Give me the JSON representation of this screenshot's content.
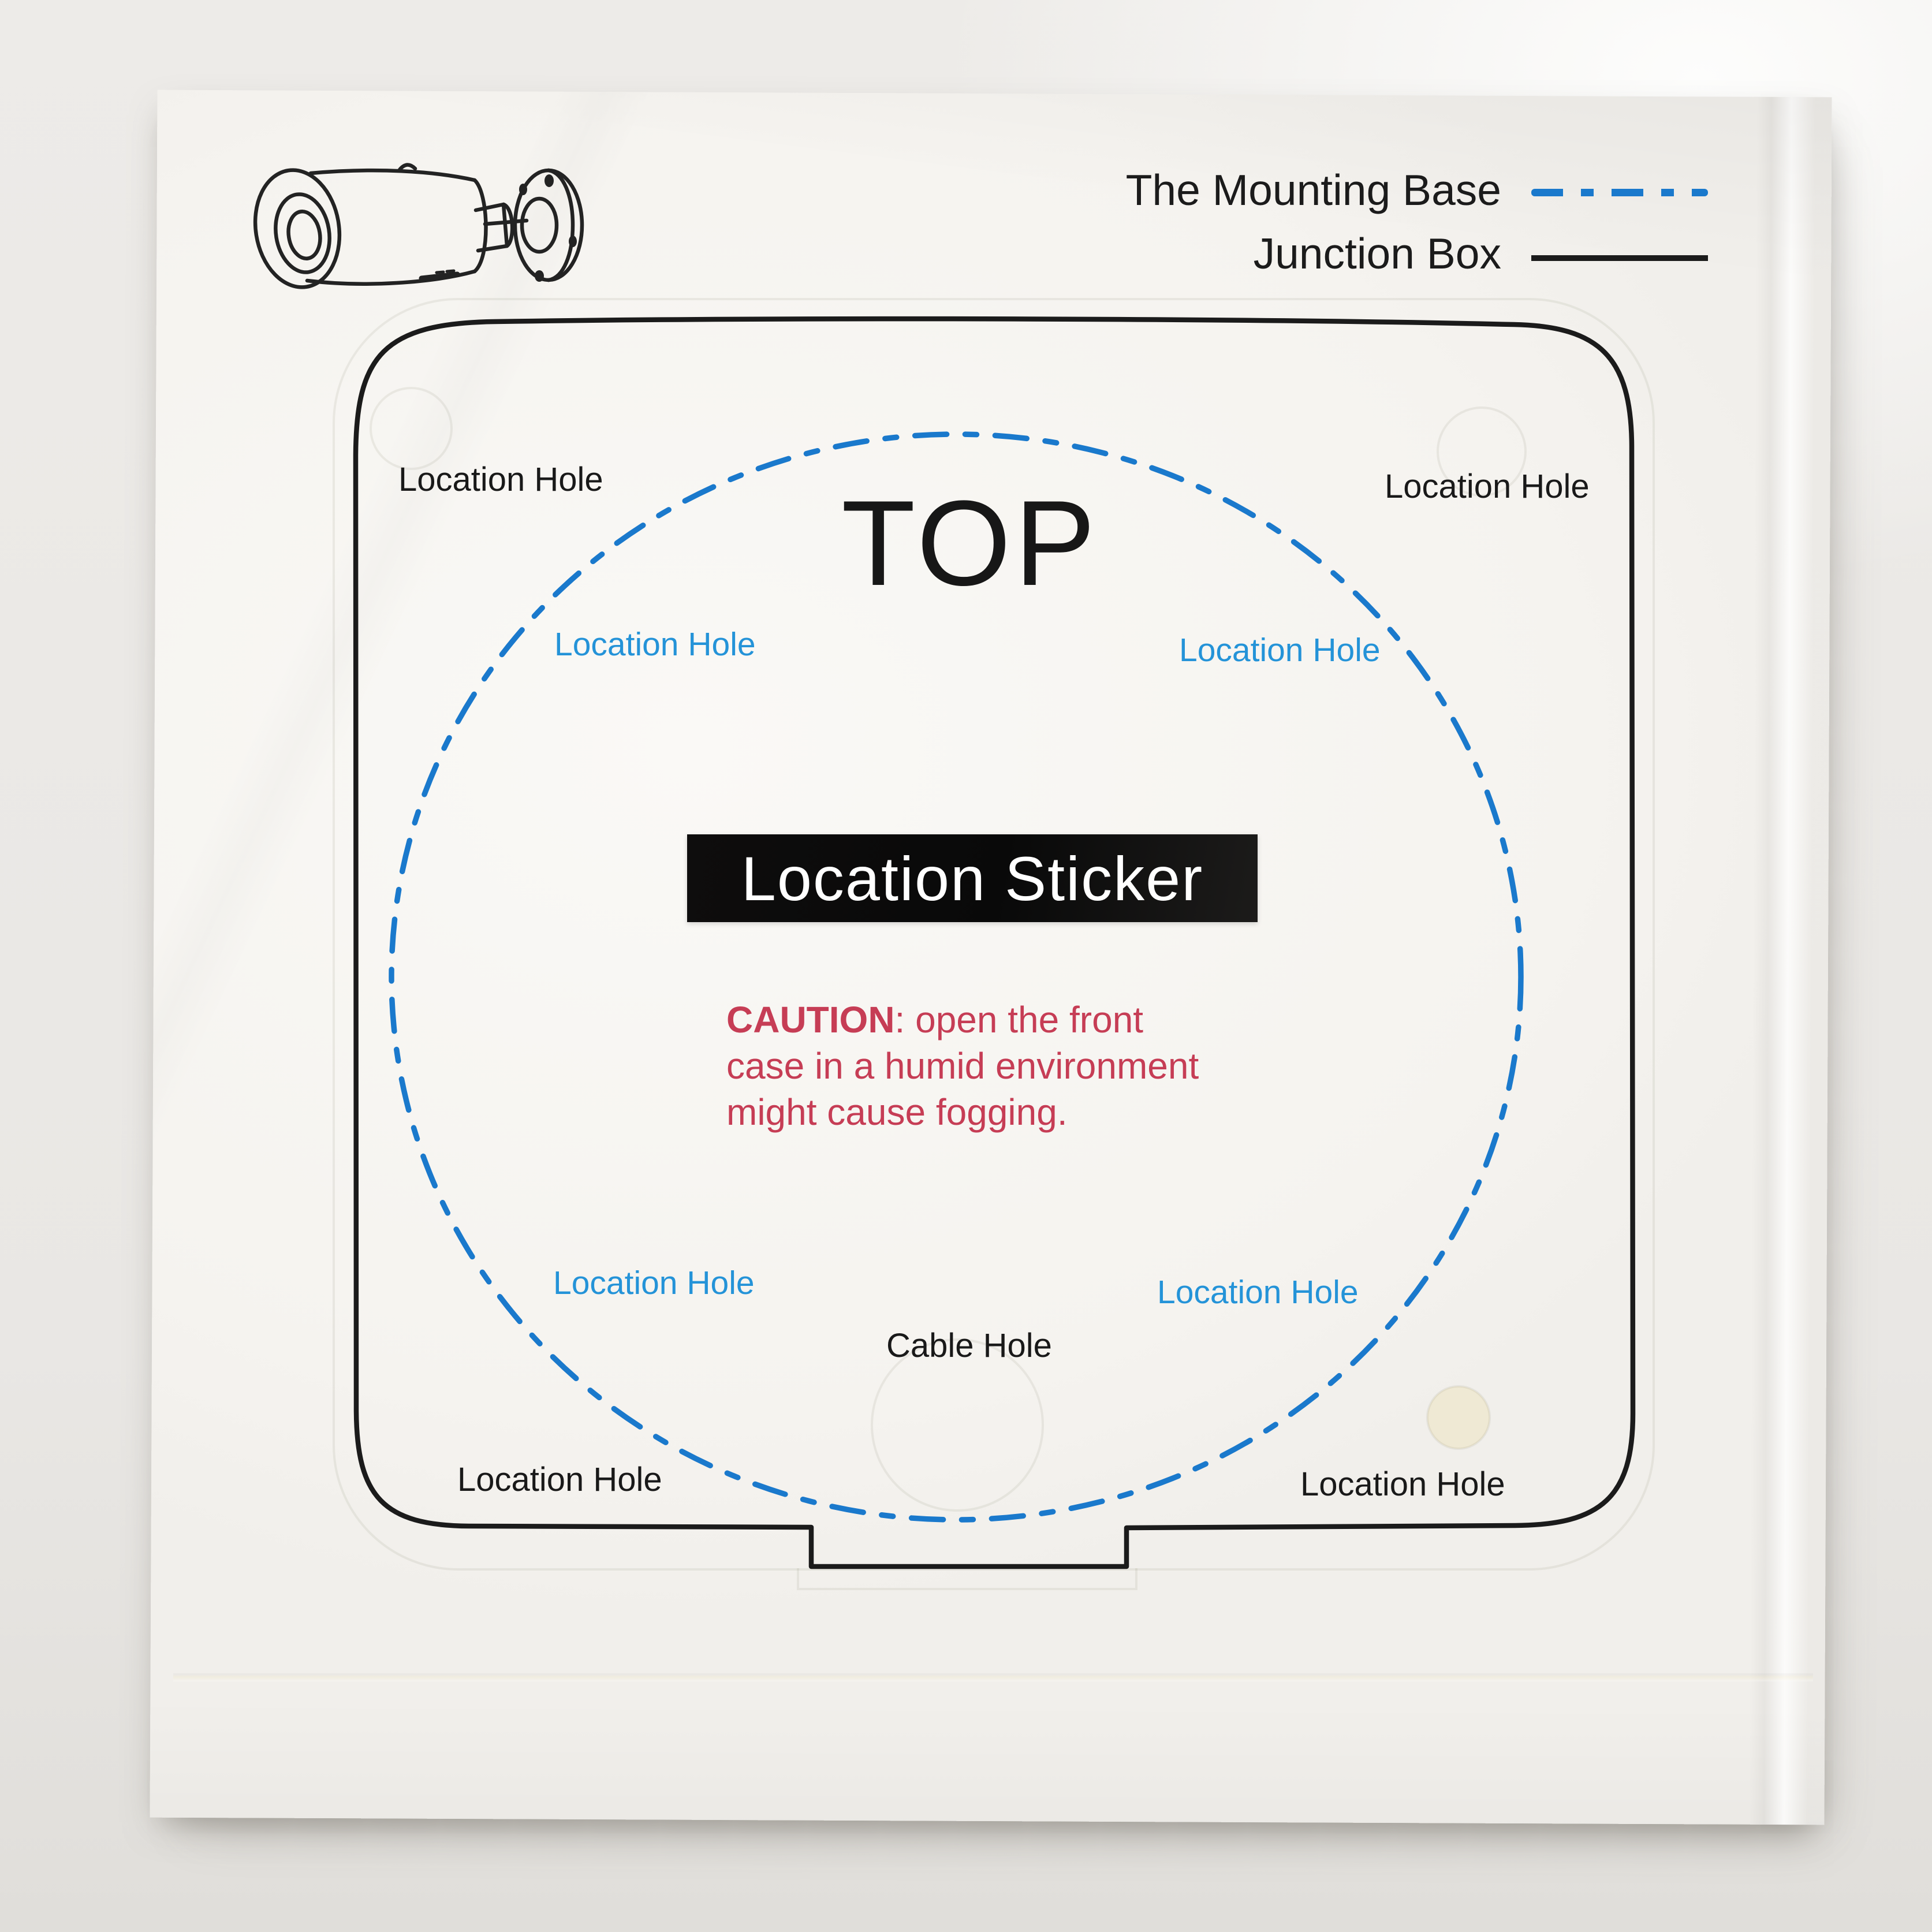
{
  "legend": {
    "mounting_base_label": "The Mounting Base",
    "junction_box_label": "Junction Box"
  },
  "sticker": {
    "top_label": "TOP",
    "title_badge": "Location Sticker",
    "cable_hole_label": "Cable Hole",
    "caution_bold": "CAUTION",
    "caution_line1_rest": ": open the front",
    "caution_line2": "case in a humid environment",
    "caution_line3": "might cause fogging.",
    "junction_box_holes": {
      "top_left": "Location Hole",
      "top_right": "Location Hole",
      "bottom_left": "Location Hole",
      "bottom_right": "Location Hole"
    },
    "mounting_base_holes": {
      "upper_left": "Location Hole",
      "upper_right": "Location Hole",
      "lower_left": "Location Hole",
      "lower_right": "Location Hole"
    }
  },
  "colors": {
    "mounting_base_blue": "#1a79cc",
    "blue_label": "#2493d8",
    "junction_box_black": "#1b1b1b",
    "caution_red": "#c63d55",
    "badge_bg": "#0b0b0b",
    "badge_text": "#ffffff"
  }
}
